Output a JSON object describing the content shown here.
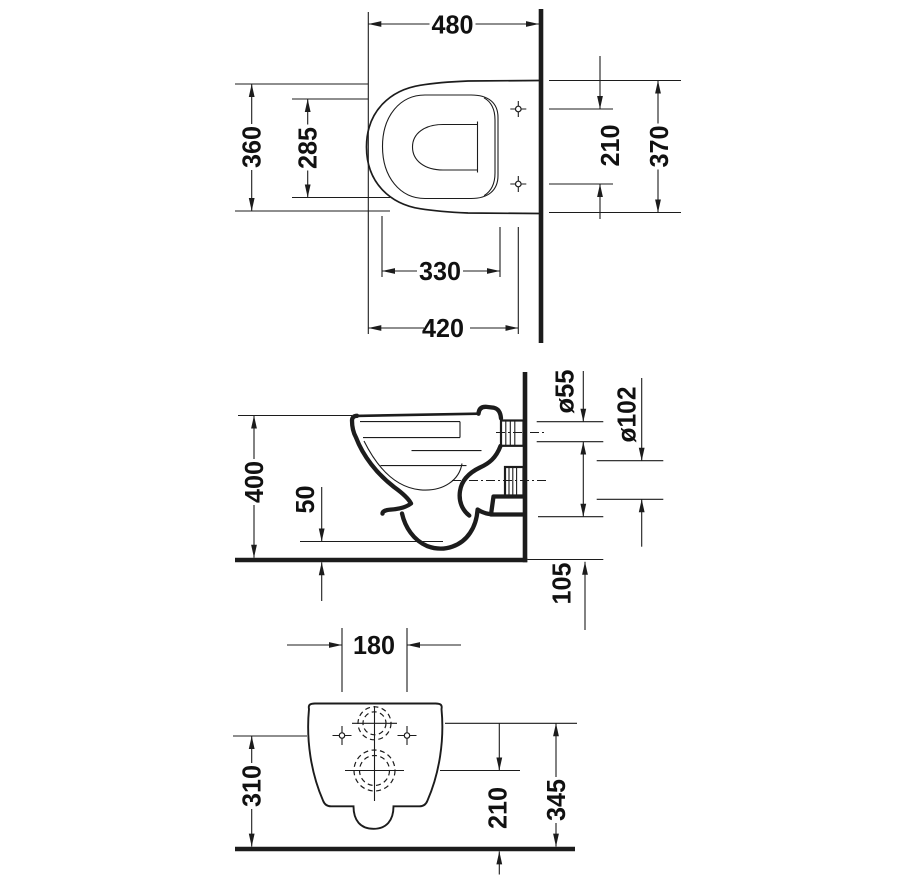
{
  "drawing_colors": {
    "line": "#1c1c1c",
    "background": "#ffffff"
  },
  "plan_view": {
    "total_depth": "480",
    "bowl_width": "360",
    "inner_width": "285",
    "fixing_hole_spacing": "210",
    "back_width": "370",
    "inner_depth": "330",
    "fixing_hole_depth": "420"
  },
  "side_view": {
    "height": "400",
    "front_clearance": "50",
    "flush_inlet_diameter": "ø55",
    "outlet_diameter": "ø102",
    "outlet_offset": "105"
  },
  "rear_view": {
    "fixing_hole_spacing": "180",
    "fixing_hole_height": "310",
    "outlet_height": "210",
    "flush_inlet_height": "345"
  }
}
